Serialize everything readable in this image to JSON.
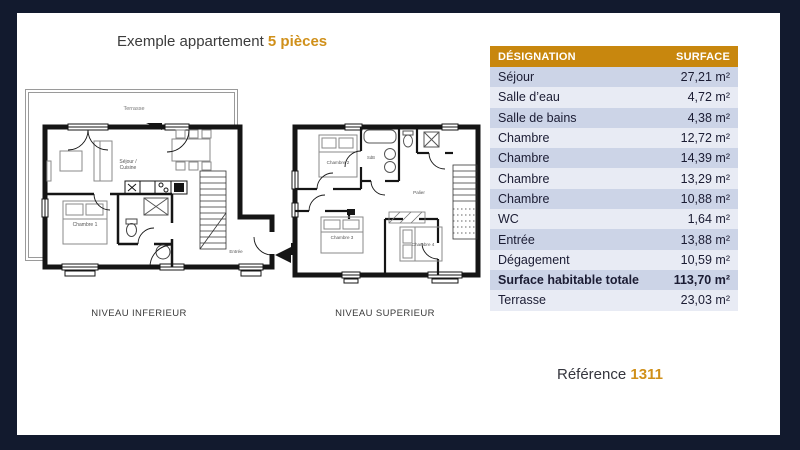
{
  "colors": {
    "accent": "#d0901a",
    "table_header_bg": "#c8870e",
    "frame": "#121a2e",
    "row_dark": "#ccd4e7",
    "row_light": "#e8ebf4"
  },
  "header": {
    "title_prefix": "Exemple appartement",
    "title_highlight": "5 pièces"
  },
  "plans": {
    "inferior": {
      "caption": "NIVEAU INFERIEUR",
      "rooms": {
        "terrasse": "Terrasse",
        "sejour_line1": "Séjour /",
        "sejour_line2": "Cuisine",
        "chambre1": "Chambre 1",
        "entree": "Entrée"
      }
    },
    "superior": {
      "caption": "NIVEAU SUPERIEUR",
      "rooms": {
        "chambre2": "Chambre 2",
        "chambre3": "Chambre 3",
        "chambre4": "Chambre 4",
        "palier": "Palier",
        "sdb": "SdB"
      }
    }
  },
  "table": {
    "columns": [
      "DÉSIGNATION",
      "SURFACE"
    ],
    "rows": [
      {
        "label": "Séjour",
        "value": "27,21 m²"
      },
      {
        "label": "Salle d’eau",
        "value": "4,72 m²"
      },
      {
        "label": "Salle de bains",
        "value": "4,38 m²"
      },
      {
        "label": "Chambre",
        "value": "12,72 m²"
      },
      {
        "label": "Chambre",
        "value": "14,39 m²"
      },
      {
        "label": "Chambre",
        "value": "13,29 m²"
      },
      {
        "label": "Chambre",
        "value": "10,88 m²"
      },
      {
        "label": "WC",
        "value": "1,64 m²"
      },
      {
        "label": "Entrée",
        "value": "13,88 m²"
      },
      {
        "label": "Dégagement",
        "value": "10,59 m²"
      },
      {
        "label": "Surface habitable totale",
        "value": "113,70 m²"
      },
      {
        "label": "Terrasse",
        "value": "23,03 m²"
      }
    ]
  },
  "footer": {
    "reference_label": "Référence",
    "reference_value": "1311"
  }
}
